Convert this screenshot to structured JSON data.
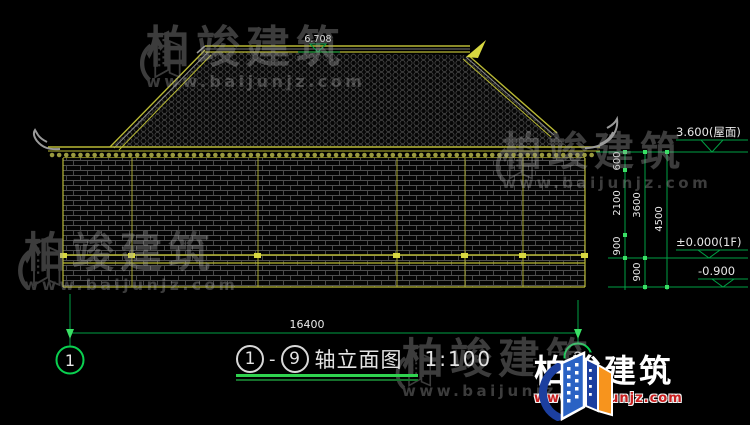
{
  "drawing": {
    "title": {
      "axis_start": "1",
      "axis_end": "9",
      "dash": "-",
      "label": "轴立面图",
      "scale": "1:100"
    },
    "axis_bubbles": {
      "left": "1",
      "right": "9"
    },
    "dimensions": {
      "overall_width": "16400",
      "right_chain": {
        "d600": "600",
        "d2100": "2100",
        "d900a": "900",
        "d3600": "3600",
        "d900b": "900",
        "d4500": "4500"
      }
    },
    "levels": {
      "ridge": "6.708",
      "eave": "3.600(屋面)",
      "floor": "±0.000(1F)",
      "ground": "-0.900"
    }
  },
  "watermark": {
    "company": "柏竣建筑",
    "website": "www.baijunjz.com"
  },
  "brand_logo": {
    "company": "柏竣建筑",
    "website": "www.baijunjz.com"
  },
  "colors": {
    "line_yellow": "#b9b935",
    "dim_green": "#00a044",
    "tick_green": "#3ae065",
    "text_white": "#e8e8e8",
    "brand_red": "#c81e1e",
    "brand_blue": "#2a62c4",
    "brand_orange": "#f7941d"
  }
}
